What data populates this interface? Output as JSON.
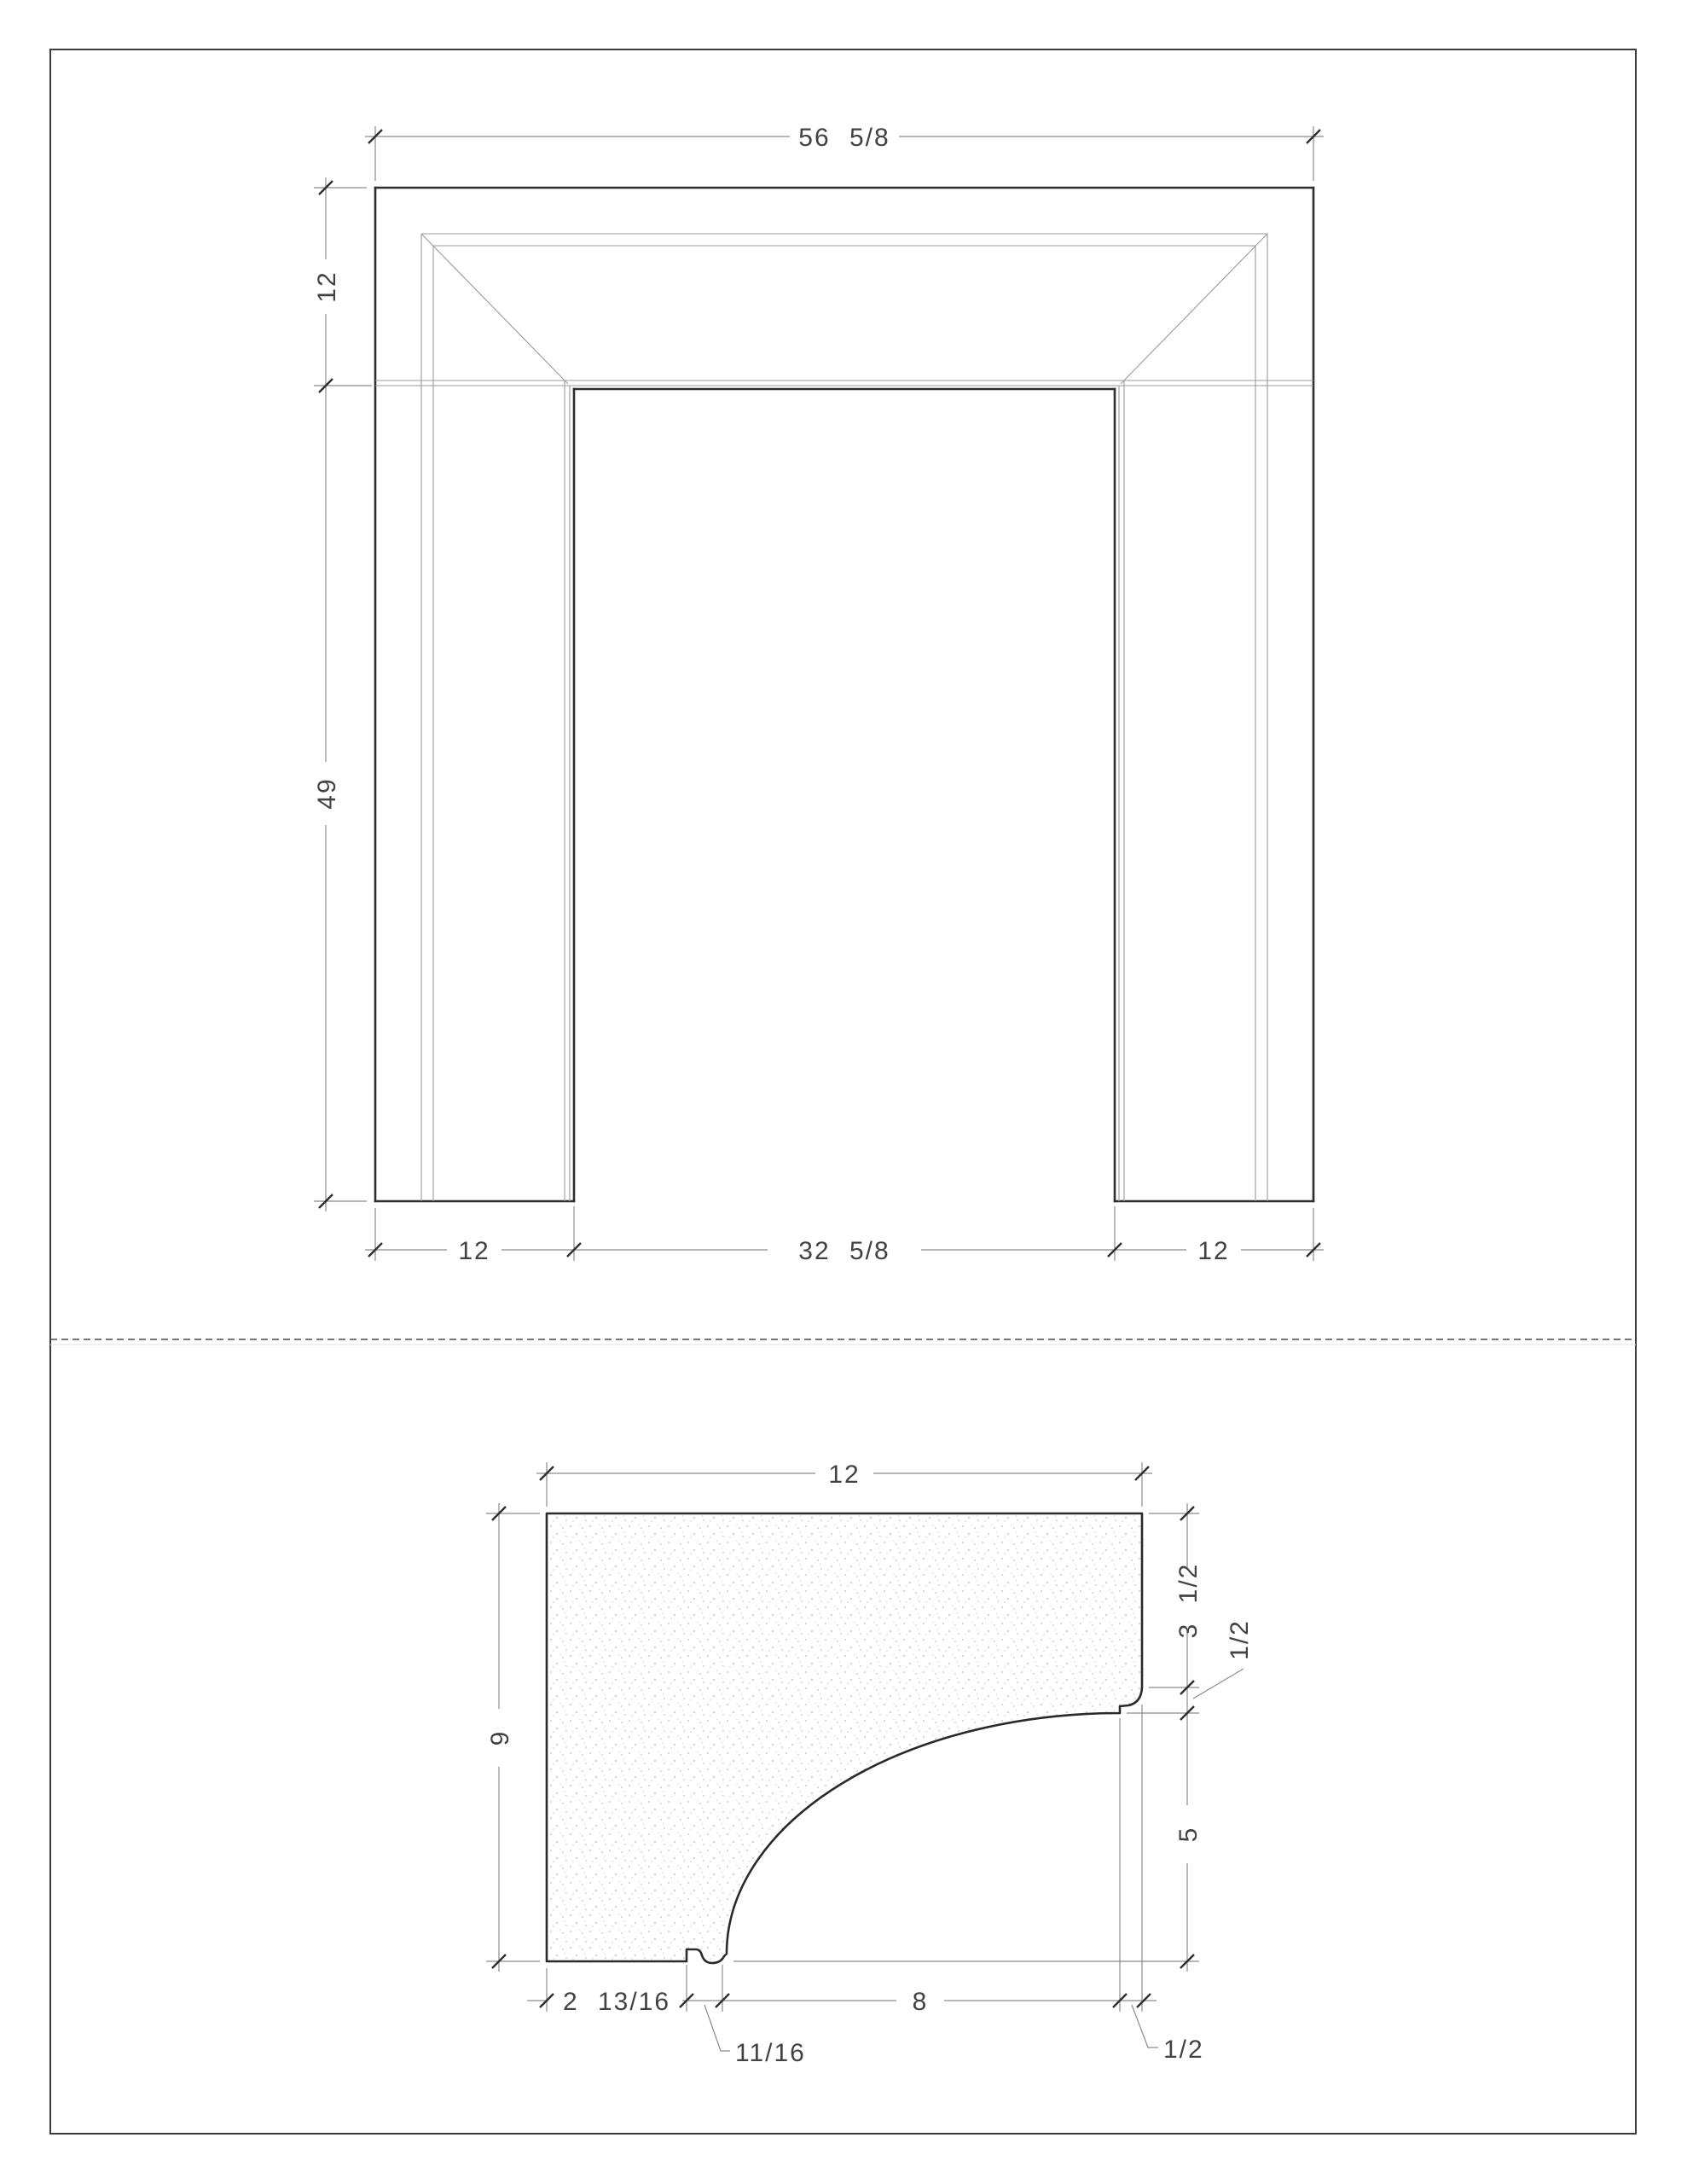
{
  "page": {
    "type": "cad-shop-drawing",
    "background": "#ffffff",
    "border_color": "#3c3c3c"
  },
  "colors": {
    "heavy_line": "#2e2e2e",
    "thin_line": "#9b9b9b",
    "dimension_line": "#8c8c8c",
    "text": "#424242",
    "stipple": "#cccccc"
  },
  "elevation": {
    "name": "mantel front elevation",
    "dims": {
      "overall_width": "56 5/8",
      "frieze_height": "12",
      "leg_height": "49",
      "left_leg_width": "12",
      "opening_width": "32 5/8",
      "right_leg_width": "12"
    }
  },
  "section": {
    "name": "leg section profile",
    "dims": {
      "width": "12",
      "height": "9",
      "upper_right_height": "3 1/2",
      "ogee_height": "1/2",
      "cove_rise": "5",
      "bottom_left_width": "2 13/16",
      "groove_width": "11/16",
      "cove_run": "8",
      "right_step_width": "1/2"
    }
  }
}
